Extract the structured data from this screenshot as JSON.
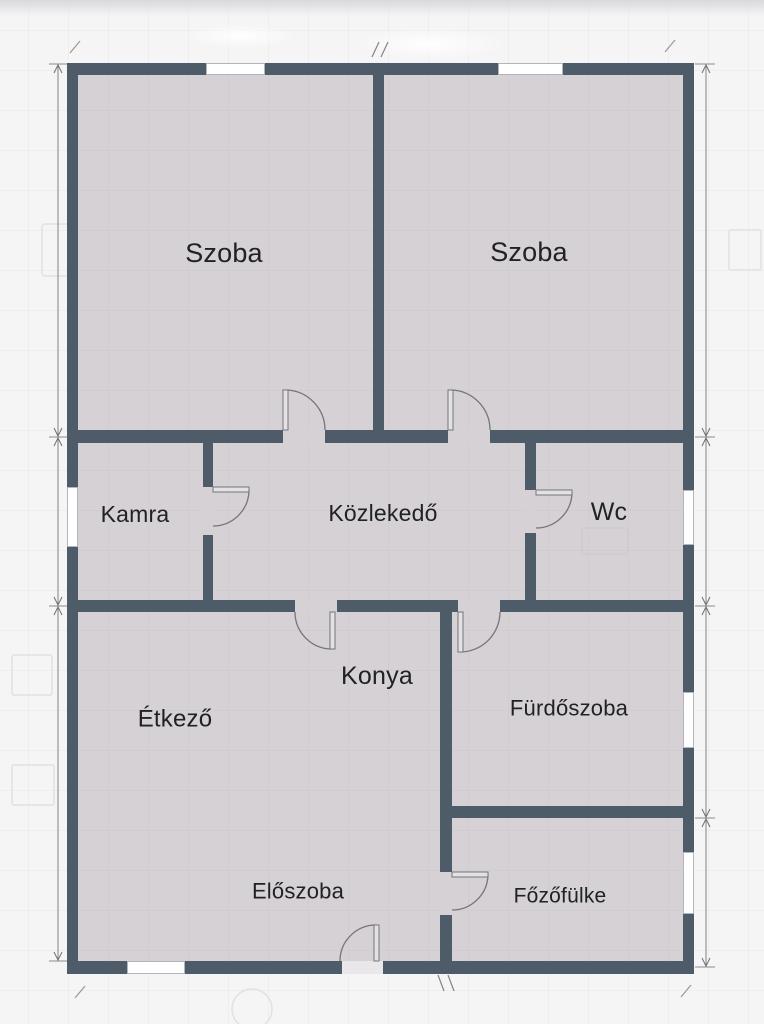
{
  "floorplan": {
    "canvas": {
      "width": 764,
      "height": 1024
    },
    "colors": {
      "background": "#f5f5f6",
      "grid": "#e8e8eb",
      "room_fill": "#d5d1d5",
      "room_grid": "#cac6cb",
      "wall": "#4e5c69",
      "door_line": "#75757a",
      "door_leaf_fill": "#e3e1e3",
      "window_fill": "#ffffff",
      "window_frame": "#a9aeb5",
      "dimension": "#707074",
      "label": "#202226",
      "ghost": "#e1e1e5",
      "ghost_inside": "#c5c1c6",
      "threshold": "#eae7ea",
      "top_fade": "#d7d7da"
    },
    "rooms": [
      {
        "id": "szoba-left",
        "label": "Szoba",
        "cx": 224,
        "cy": 253,
        "fs": 27
      },
      {
        "id": "szoba-right",
        "label": "Szoba",
        "cx": 529,
        "cy": 252,
        "fs": 27
      },
      {
        "id": "kamra",
        "label": "Kamra",
        "cx": 135,
        "cy": 514,
        "fs": 23
      },
      {
        "id": "kozlekedo",
        "label": "Közlekedő",
        "cx": 383,
        "cy": 513,
        "fs": 23
      },
      {
        "id": "wc",
        "label": "Wc",
        "cx": 609,
        "cy": 512,
        "fs": 25
      },
      {
        "id": "etkezo",
        "label": "Étkező",
        "cx": 175,
        "cy": 719,
        "fs": 24
      },
      {
        "id": "konya",
        "label": "Konya",
        "cx": 377,
        "cy": 676,
        "fs": 25
      },
      {
        "id": "furdoszoba",
        "label": "Fürdőszoba",
        "cx": 569,
        "cy": 708,
        "fs": 22
      },
      {
        "id": "eloszoba",
        "label": "Előszoba",
        "cx": 298,
        "cy": 891,
        "fs": 22
      },
      {
        "id": "fozofulke",
        "label": "Főzőfülke",
        "cx": 560,
        "cy": 896,
        "fs": 21
      }
    ],
    "interior": {
      "x": 67,
      "y": 63,
      "w": 627,
      "h": 911
    },
    "walls": [
      {
        "name": "outer-top",
        "x": 67,
        "y": 63,
        "w": 627,
        "h": 12
      },
      {
        "name": "outer-bottom",
        "x": 67,
        "y": 961,
        "w": 627,
        "h": 13
      },
      {
        "name": "outer-left",
        "x": 67,
        "y": 63,
        "w": 11,
        "h": 911
      },
      {
        "name": "outer-right",
        "x": 683,
        "y": 63,
        "w": 11,
        "h": 911
      },
      {
        "name": "szoba-divider",
        "x": 373,
        "y": 75,
        "w": 11,
        "h": 355
      },
      {
        "name": "szoba-bottom",
        "x": 67,
        "y": 430,
        "w": 627,
        "h": 13
      },
      {
        "name": "kamra-divider",
        "x": 203,
        "y": 443,
        "w": 10,
        "h": 157
      },
      {
        "name": "wc-divider",
        "x": 525,
        "y": 443,
        "w": 11,
        "h": 157
      },
      {
        "name": "kozlekedo-bottom",
        "x": 67,
        "y": 600,
        "w": 627,
        "h": 12
      },
      {
        "name": "lower-vertical",
        "x": 440,
        "y": 612,
        "w": 12,
        "h": 349
      },
      {
        "name": "furdo-fozo-divider",
        "x": 440,
        "y": 806,
        "w": 254,
        "h": 12
      }
    ],
    "openings": [
      {
        "name": "szoba-left-doorway",
        "x": 283,
        "y": 430,
        "w": 42,
        "h": 13,
        "t": false
      },
      {
        "name": "szoba-right-doorway",
        "x": 448,
        "y": 430,
        "w": 42,
        "h": 13,
        "t": false
      },
      {
        "name": "kamra-doorway",
        "x": 203,
        "y": 487,
        "w": 10,
        "h": 48,
        "t": false
      },
      {
        "name": "wc-doorway",
        "x": 525,
        "y": 490,
        "w": 11,
        "h": 43,
        "t": false
      },
      {
        "name": "konya-doorway",
        "x": 295,
        "y": 600,
        "w": 42,
        "h": 12,
        "t": false
      },
      {
        "name": "furdo-doorway",
        "x": 458,
        "y": 600,
        "w": 42,
        "h": 12,
        "t": false
      },
      {
        "name": "fozo-doorway",
        "x": 440,
        "y": 872,
        "w": 12,
        "h": 43,
        "t": false
      },
      {
        "name": "entrance-doorway",
        "x": 342,
        "y": 961,
        "w": 41,
        "h": 13,
        "t": true
      }
    ],
    "windows": [
      {
        "name": "szoba-left-window",
        "x": 206,
        "y": 63,
        "w": 59,
        "h": 12
      },
      {
        "name": "szoba-right-window",
        "x": 498,
        "y": 63,
        "w": 65,
        "h": 12
      },
      {
        "name": "kamra-window",
        "x": 67,
        "y": 487,
        "w": 11,
        "h": 60
      },
      {
        "name": "wc-window",
        "x": 683,
        "y": 490,
        "w": 11,
        "h": 55
      },
      {
        "name": "furdo-window",
        "x": 683,
        "y": 692,
        "w": 11,
        "h": 56
      },
      {
        "name": "fozo-window",
        "x": 683,
        "y": 852,
        "w": 11,
        "h": 62
      },
      {
        "name": "eloszoba-window",
        "x": 127,
        "y": 961,
        "w": 58,
        "h": 13
      }
    ],
    "doors": [
      {
        "name": "szoba-left-door",
        "leaf": [
          283,
          390,
          5,
          40
        ],
        "arc": "M286 390 A40 40 0 0 1 325 430"
      },
      {
        "name": "szoba-right-door",
        "leaf": [
          448,
          390,
          5,
          40
        ],
        "arc": "M451 390 A40 40 0 0 1 490 430"
      },
      {
        "name": "kamra-door",
        "leaf": [
          213,
          487,
          36,
          5
        ],
        "arc": "M249 490 A36 36 0 0 1 213 526"
      },
      {
        "name": "wc-door",
        "leaf": [
          536,
          490,
          36,
          5
        ],
        "arc": "M572 492 A36 36 0 0 1 536 528"
      },
      {
        "name": "konya-door",
        "leaf": [
          330,
          612,
          5,
          37
        ],
        "arc": "M332 649 A37 37 0 0 1 295 612"
      },
      {
        "name": "furdo-door",
        "leaf": [
          458,
          612,
          5,
          40
        ],
        "arc": "M460 652 A40 40 0 0 0 500 612"
      },
      {
        "name": "fozo-door",
        "leaf": [
          452,
          872,
          36,
          5
        ],
        "arc": "M488 874 A36 36 0 0 1 452 910"
      },
      {
        "name": "entrance-door",
        "leaf": [
          374,
          925,
          5,
          36
        ],
        "arc": "M376 925 A36 36 0 0 0 340 961"
      }
    ],
    "dimensions": {
      "lines": [
        {
          "name": "dim-left",
          "x": 58,
          "y1": 64,
          "y2": 961,
          "breaks": [
            64,
            437,
            606,
            961
          ],
          "tick_x1": 49,
          "tick_x2": 67
        },
        {
          "name": "dim-right",
          "x": 706,
          "y1": 64,
          "y2": 967,
          "breaks": [
            64,
            437,
            606,
            818,
            967
          ],
          "tick_x1": 695,
          "tick_x2": 715
        }
      ],
      "double_ticks": [
        "M372 57 L379 42",
        "M381 57 L388 42",
        "M438 975 L444 991",
        "M448 975 L454 991"
      ],
      "corner_slashes": [
        "M70 53 L80 41",
        "M665 52 L675 40",
        "M75 998 L85 986",
        "M681 997 L691 985"
      ]
    },
    "ghosts": [
      {
        "k": "rect",
        "x": 42,
        "y": 224,
        "w": 28,
        "h": 52,
        "rx": 3,
        "inside": false
      },
      {
        "k": "rect",
        "x": 729,
        "y": 230,
        "w": 32,
        "h": 40,
        "rx": 2,
        "inside": false
      },
      {
        "k": "rect",
        "x": 12,
        "y": 655,
        "w": 40,
        "h": 40,
        "rx": 2,
        "inside": false
      },
      {
        "k": "rect",
        "x": 12,
        "y": 765,
        "w": 42,
        "h": 40,
        "rx": 2,
        "inside": false
      },
      {
        "k": "circle",
        "cx": 252,
        "cy": 1009,
        "r": 20,
        "inside": false
      },
      {
        "k": "rect",
        "x": 582,
        "y": 528,
        "w": 46,
        "h": 26,
        "rx": 2,
        "inside": true
      }
    ],
    "soft_patches": [
      {
        "cx": 430,
        "cy": 44,
        "rx": 75,
        "ry": 16
      },
      {
        "cx": 240,
        "cy": 36,
        "rx": 55,
        "ry": 12
      }
    ],
    "grid": {
      "size": 40,
      "offset_x": 28,
      "offset_y": 30
    }
  }
}
